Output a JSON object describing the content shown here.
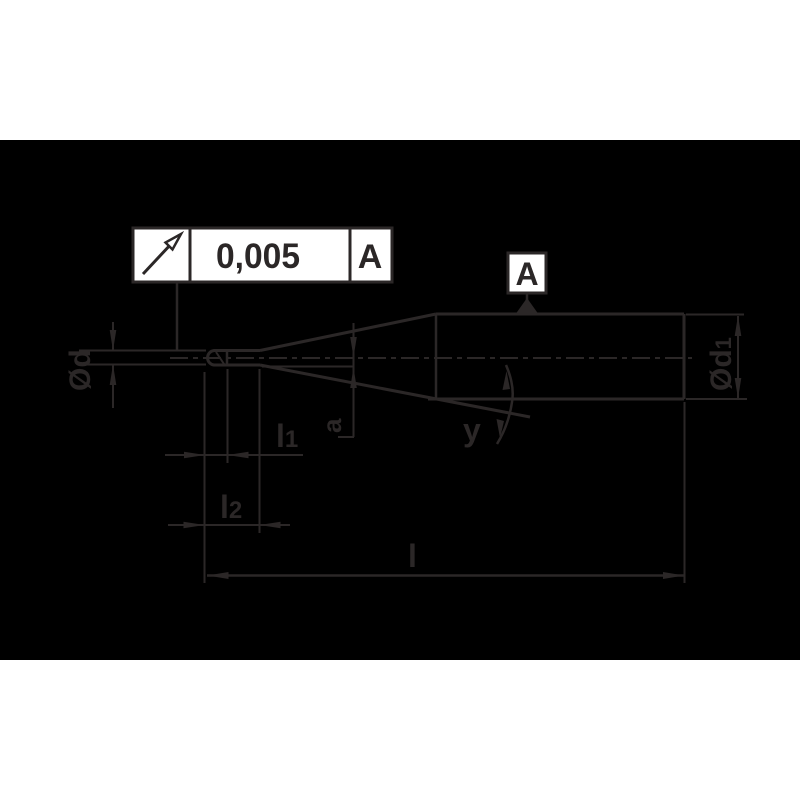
{
  "drawing": {
    "type": "technical-dimension-drawing",
    "subject": "tapered-neck ball nose end mill side view",
    "colors": {
      "paper": "#ffffff",
      "panel_background": "#000000",
      "stroke": "#2b2727",
      "shape_fill": "#ffffff"
    },
    "feature_control_frame": {
      "icon": "circular-runout-arrow",
      "tolerance": "0,005",
      "datum_reference": "A"
    },
    "datum_flag": {
      "label": "A"
    },
    "labels": {
      "tip_diameter": "Ød",
      "shank_diameter_main": "Ød",
      "shank_diameter_sub": "1",
      "cutting_length_main": "l",
      "cutting_length_sub": "1",
      "neck_length_main": "l",
      "neck_length_sub": "2",
      "overall_length": "l",
      "neck_offset": "a",
      "taper_angle": "y"
    }
  }
}
